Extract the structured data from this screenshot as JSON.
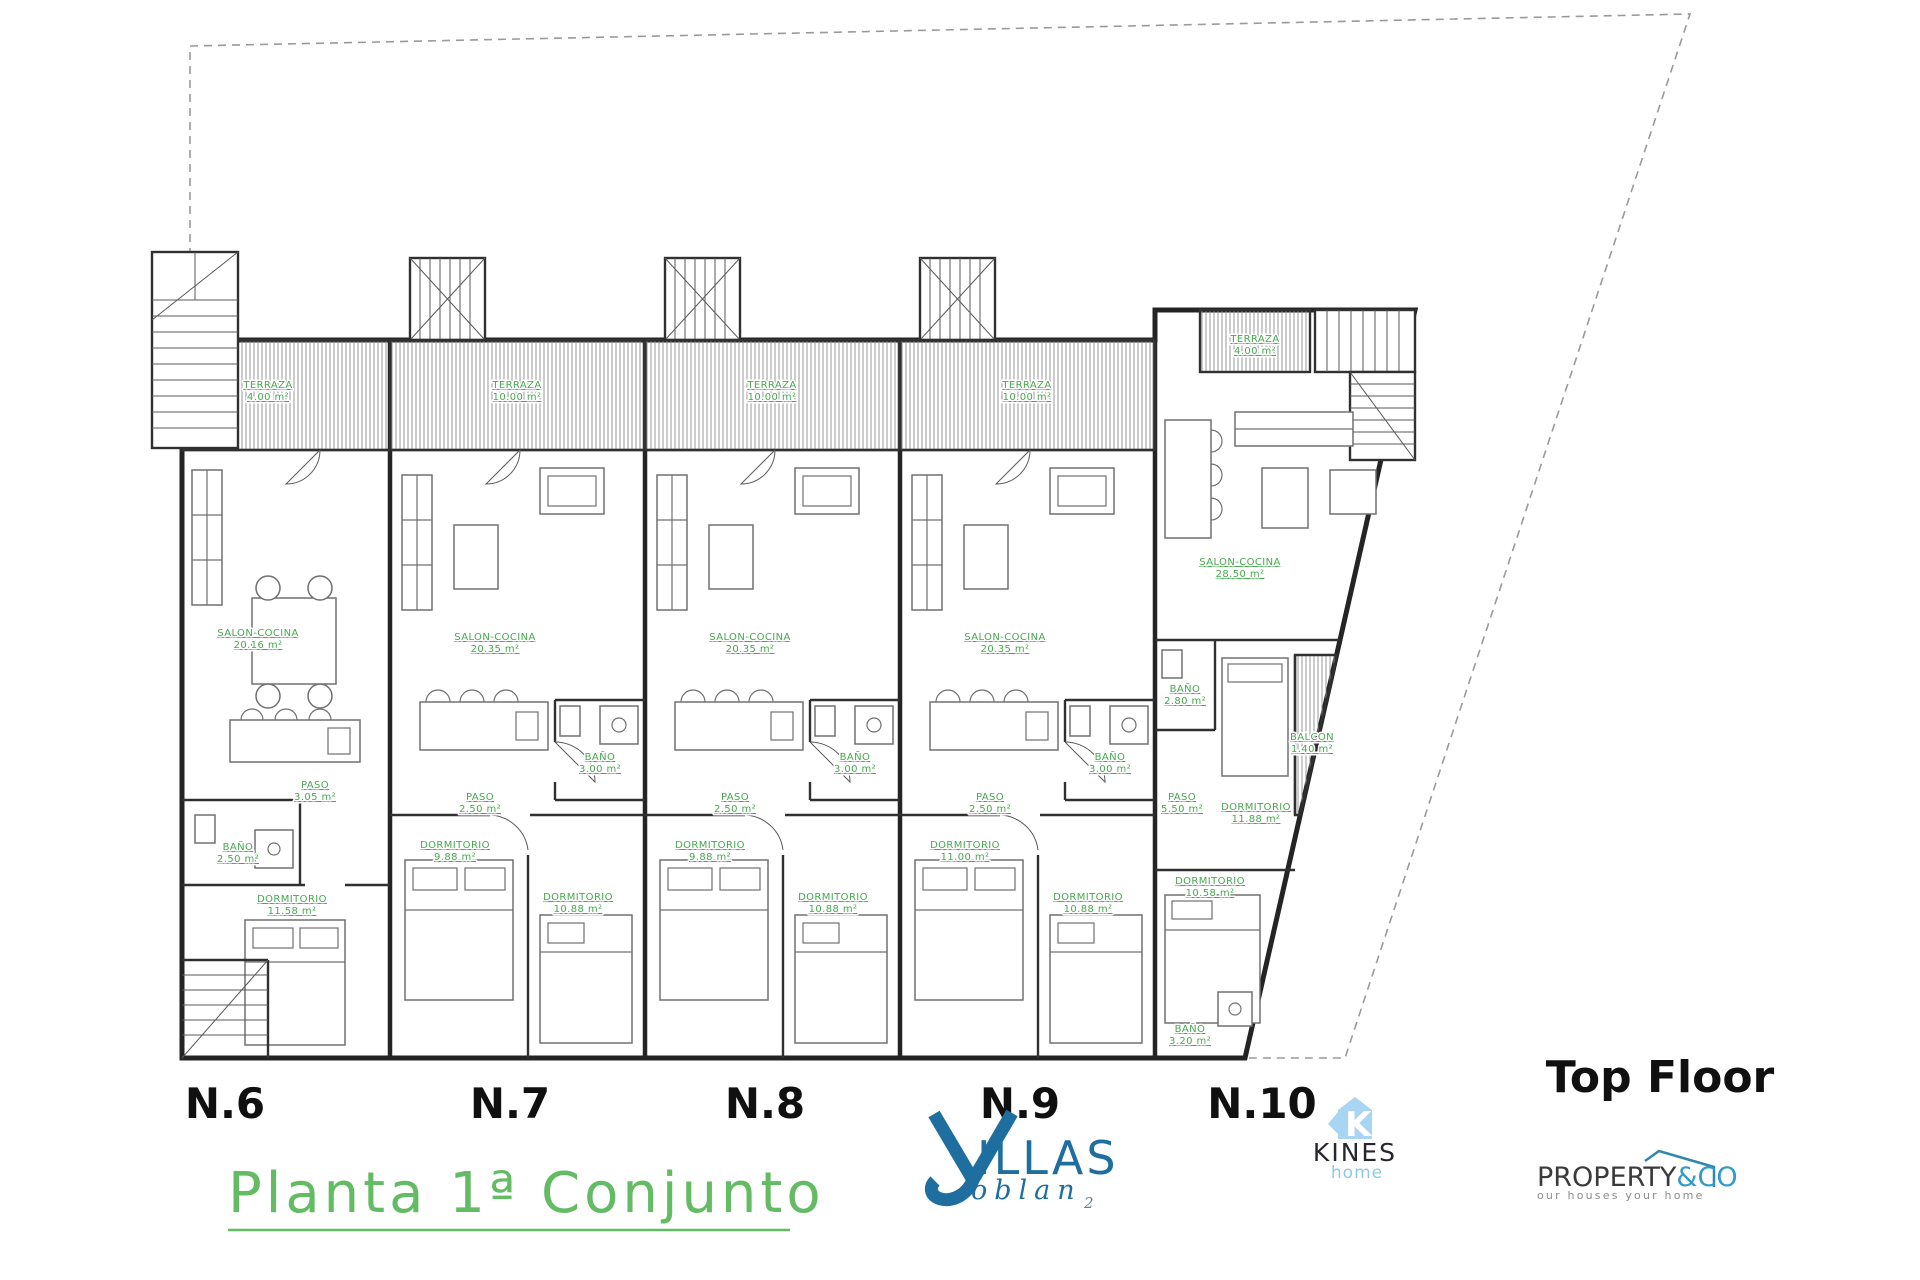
{
  "title": {
    "text": "Planta 1ª Conjunto"
  },
  "floor_label": "Top Floor",
  "plan": {
    "units": [
      {
        "id": "N.6",
        "label_x": 225,
        "rooms": [
          {
            "name": "TERRAZA",
            "area": "4.00 m²",
            "x": 268,
            "y": 388
          },
          {
            "name": "SALON-COCINA",
            "area": "20.16 m²",
            "x": 258,
            "y": 636
          },
          {
            "name": "PASO",
            "area": "3.05 m²",
            "x": 315,
            "y": 788
          },
          {
            "name": "BAÑO",
            "area": "2.50 m²",
            "x": 238,
            "y": 850
          },
          {
            "name": "DORMITORIO",
            "area": "11.58 m²",
            "x": 292,
            "y": 902
          }
        ]
      },
      {
        "id": "N.7",
        "label_x": 510,
        "rooms": [
          {
            "name": "TERRAZA",
            "area": "10.00 m²",
            "x": 517,
            "y": 388
          },
          {
            "name": "SALON-COCINA",
            "area": "20.35 m²",
            "x": 495,
            "y": 640
          },
          {
            "name": "BAÑO",
            "area": "3.00 m²",
            "x": 600,
            "y": 760
          },
          {
            "name": "PASO",
            "area": "2.50 m²",
            "x": 480,
            "y": 800
          },
          {
            "name": "DORMITORIO",
            "area": "9.88 m²",
            "x": 455,
            "y": 848
          },
          {
            "name": "DORMITORIO",
            "area": "10.88 m²",
            "x": 578,
            "y": 900
          }
        ]
      },
      {
        "id": "N.8",
        "label_x": 765,
        "rooms": [
          {
            "name": "TERRAZA",
            "area": "10.00 m²",
            "x": 772,
            "y": 388
          },
          {
            "name": "SALON-COCINA",
            "area": "20.35 m²",
            "x": 750,
            "y": 640
          },
          {
            "name": "BAÑO",
            "area": "3.00 m²",
            "x": 855,
            "y": 760
          },
          {
            "name": "PASO",
            "area": "2.50 m²",
            "x": 735,
            "y": 800
          },
          {
            "name": "DORMITORIO",
            "area": "9.88 m²",
            "x": 710,
            "y": 848
          },
          {
            "name": "DORMITORIO",
            "area": "10.88 m²",
            "x": 833,
            "y": 900
          }
        ]
      },
      {
        "id": "N.9",
        "label_x": 1020,
        "rooms": [
          {
            "name": "TERRAZA",
            "area": "10.00 m²",
            "x": 1027,
            "y": 388
          },
          {
            "name": "SALON-COCINA",
            "area": "20.35 m²",
            "x": 1005,
            "y": 640
          },
          {
            "name": "BAÑO",
            "area": "3.00 m²",
            "x": 1110,
            "y": 760
          },
          {
            "name": "PASO",
            "area": "2.50 m²",
            "x": 990,
            "y": 800
          },
          {
            "name": "DORMITORIO",
            "area": "11.00 m²",
            "x": 965,
            "y": 848
          },
          {
            "name": "DORMITORIO",
            "area": "10.88 m²",
            "x": 1088,
            "y": 900
          }
        ]
      },
      {
        "id": "N.10",
        "label_x": 1262,
        "rooms": [
          {
            "name": "TERRAZA",
            "area": "4.00 m²",
            "x": 1255,
            "y": 342
          },
          {
            "name": "SALON-COCINA",
            "area": "28.50 m²",
            "x": 1240,
            "y": 565
          },
          {
            "name": "BAÑO",
            "area": "2.80 m²",
            "x": 1185,
            "y": 692
          },
          {
            "name": "DORMITORIO",
            "area": "11.88 m²",
            "x": 1256,
            "y": 810
          },
          {
            "name": "BALCON",
            "area": "1.40 m²",
            "x": 1312,
            "y": 740
          },
          {
            "name": "PASO",
            "area": "5.50 m²",
            "x": 1182,
            "y": 800
          },
          {
            "name": "DORMITORIO",
            "area": "10.58 m²",
            "x": 1210,
            "y": 884
          },
          {
            "name": "BAÑO",
            "area": "3.20 m²",
            "x": 1190,
            "y": 1032
          }
        ]
      }
    ]
  },
  "logos": {
    "villas": {
      "name": "VILLAS",
      "tail": "ILLAS",
      "sub": "oblan",
      "sub_index": "2"
    },
    "kines": {
      "icon_letter": "K",
      "name": "KINES",
      "tagline": "home"
    },
    "property": {
      "name": "PROPERTY",
      "suffix": "&CO",
      "tagline": "our houses your home"
    }
  },
  "colors": {
    "room_label_green": "#46a84e",
    "title_green": "#63bb63",
    "wall_black": "#242424",
    "villas_blue": "#1e6e9f",
    "kines_light_blue": "#a8d5f1",
    "property_blue": "#2f9bc9"
  }
}
